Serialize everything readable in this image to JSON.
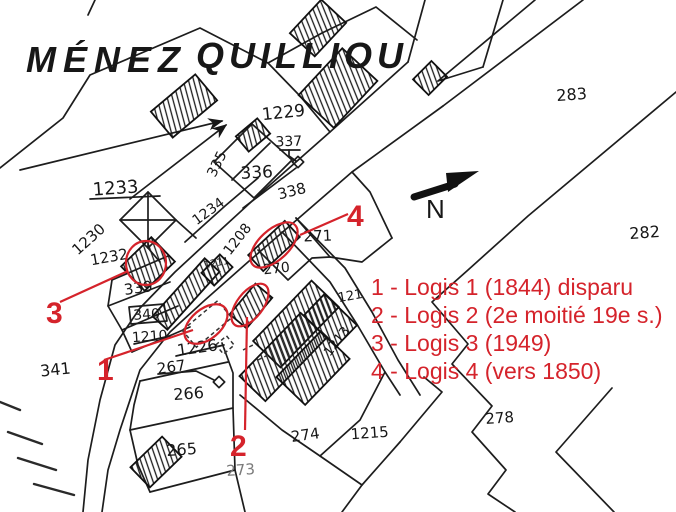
{
  "title": {
    "part1": "MÉNEZ",
    "part2": "QUILLIOU"
  },
  "north": {
    "label": "N"
  },
  "colors": {
    "annotation_red": "#d5232b",
    "ink": "#171717",
    "faded_ink": "#7a7a7a"
  },
  "legend": {
    "lines": [
      "1 - Logis 1 (1844) disparu",
      "2 - Logis 2 (2e moitié 19e s.)",
      "3 - Logis 3 (1949)",
      "4 - Logis 4 (vers 1850)"
    ]
  },
  "annotations": {
    "markers": [
      {
        "num": "1",
        "target": "logis-1"
      },
      {
        "num": "2",
        "target": "logis-2"
      },
      {
        "num": "3",
        "target": "logis-3"
      },
      {
        "num": "4",
        "target": "logis-4"
      }
    ]
  },
  "parcels": [
    {
      "label": "1229"
    },
    {
      "label": "337"
    },
    {
      "label": "336"
    },
    {
      "label": "338"
    },
    {
      "label": "335"
    },
    {
      "label": "1233"
    },
    {
      "label": "1234"
    },
    {
      "label": "1230"
    },
    {
      "label": "1232"
    },
    {
      "label": "339"
    },
    {
      "label": "340"
    },
    {
      "label": "1210"
    },
    {
      "label": "1208"
    },
    {
      "label": "1211"
    },
    {
      "label": "270"
    },
    {
      "label": "271"
    },
    {
      "label": "121"
    },
    {
      "label": "1213"
    },
    {
      "label": "1226"
    },
    {
      "label": "267"
    },
    {
      "label": "266"
    },
    {
      "label": "265"
    },
    {
      "label": "341"
    },
    {
      "label": "274"
    },
    {
      "label": "1215"
    },
    {
      "label": "273"
    },
    {
      "label": "278"
    },
    {
      "label": "283"
    },
    {
      "label": "282"
    }
  ]
}
